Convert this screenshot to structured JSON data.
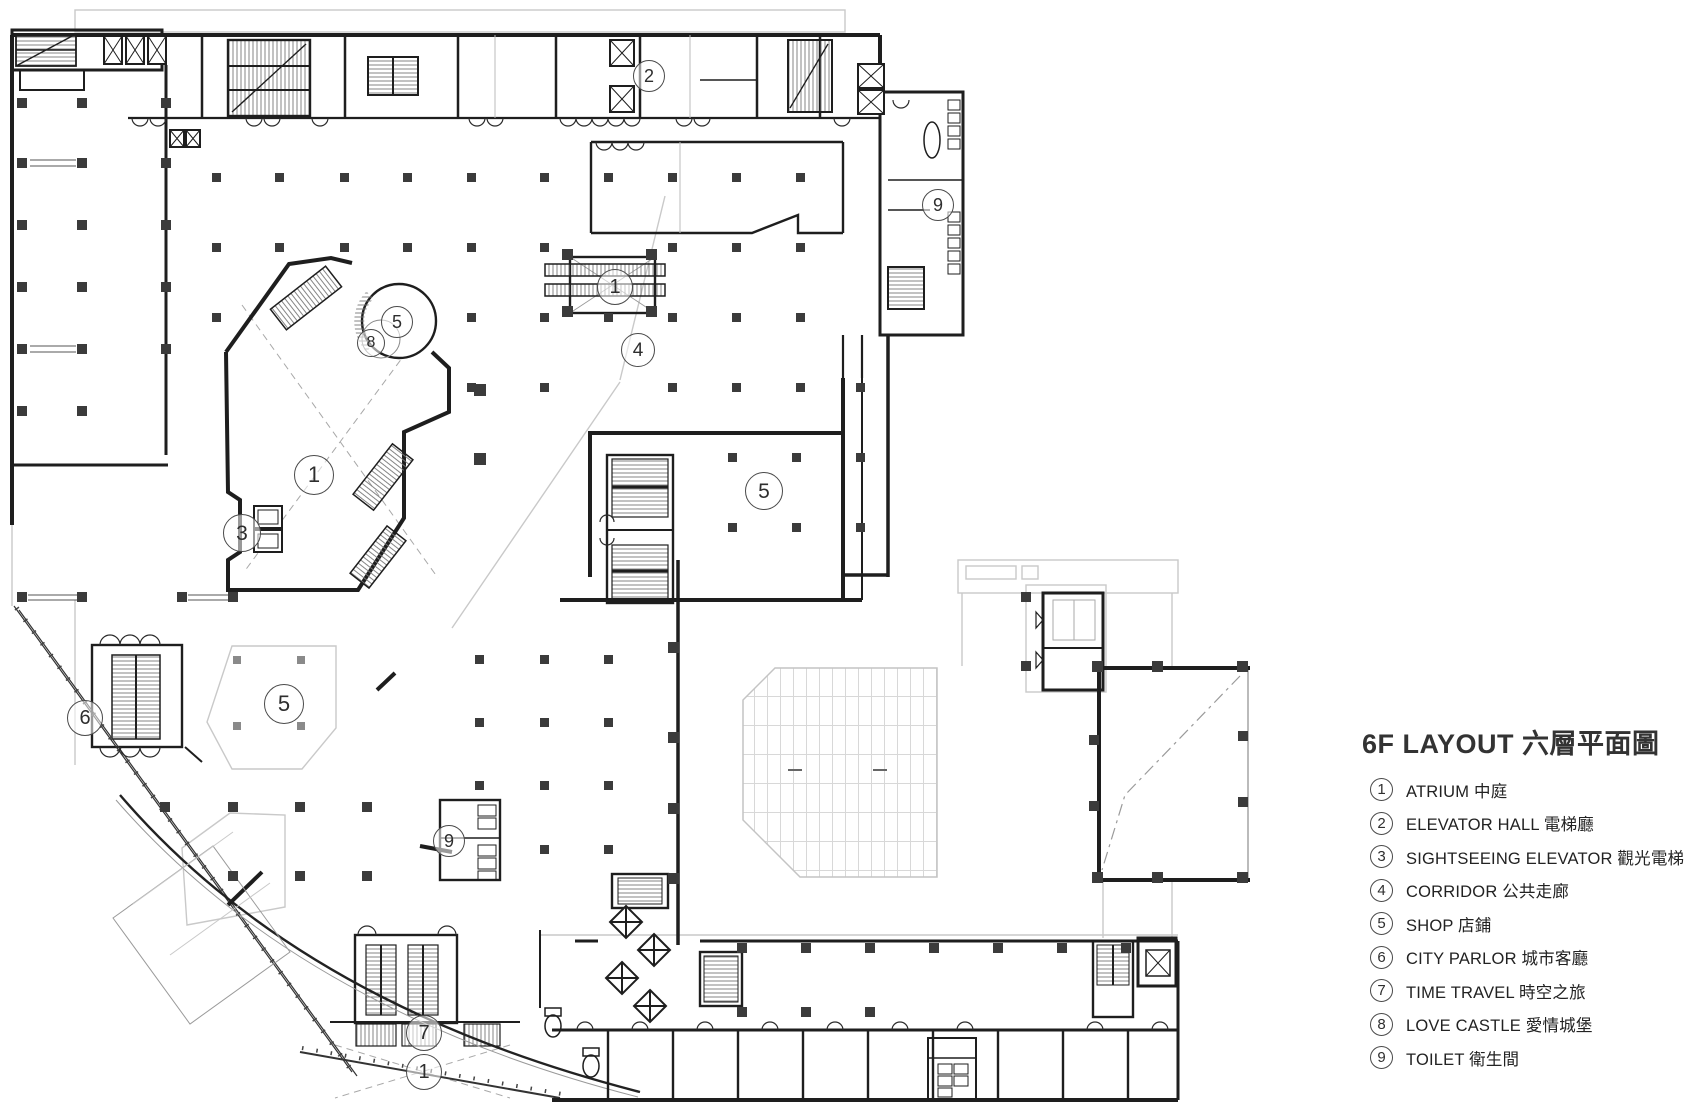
{
  "page": {
    "title": "6F LAYOUT 六層平面圖",
    "type": "architectural floor plan"
  },
  "legend": {
    "title": "6F LAYOUT 六層平面圖",
    "items": [
      {
        "num": "1",
        "label": "ATRIUM 中庭"
      },
      {
        "num": "2",
        "label": "ELEVATOR HALL 電梯廳"
      },
      {
        "num": "3",
        "label": "SIGHTSEEING ELEVATOR 觀光電梯"
      },
      {
        "num": "4",
        "label": "CORRIDOR 公共走廊"
      },
      {
        "num": "5",
        "label": "SHOP 店鋪"
      },
      {
        "num": "6",
        "label": "CITY PARLOR 城市客廳"
      },
      {
        "num": "7",
        "label": "TIME TRAVEL 時空之旅"
      },
      {
        "num": "8",
        "label": "LOVE CASTLE 愛情城堡"
      },
      {
        "num": "9",
        "label": "TOILET 衛生間"
      }
    ]
  },
  "plan": {
    "markers": [
      {
        "label": "2",
        "room": "elevator-hall"
      },
      {
        "label": "9",
        "room": "toilet-north"
      },
      {
        "label": "1",
        "room": "atrium-escalator"
      },
      {
        "label": "5",
        "room": "shop-round"
      },
      {
        "label": "8",
        "room": "love-castle"
      },
      {
        "label": "4",
        "room": "corridor"
      },
      {
        "label": "1",
        "room": "atrium-main"
      },
      {
        "label": "5",
        "room": "shop-east"
      },
      {
        "label": "3",
        "room": "sightseeing-elevator"
      },
      {
        "label": "5",
        "room": "shop-southwest"
      },
      {
        "label": "6",
        "room": "city-parlor"
      },
      {
        "label": "9",
        "room": "toilet-center"
      },
      {
        "label": "7",
        "room": "time-travel"
      },
      {
        "label": "1",
        "room": "atrium-south"
      }
    ]
  },
  "colors": {
    "wall": "#1e1e1e",
    "column": "#3b3b3b",
    "faint": "#c9c9c9",
    "hatch": "#666666"
  }
}
